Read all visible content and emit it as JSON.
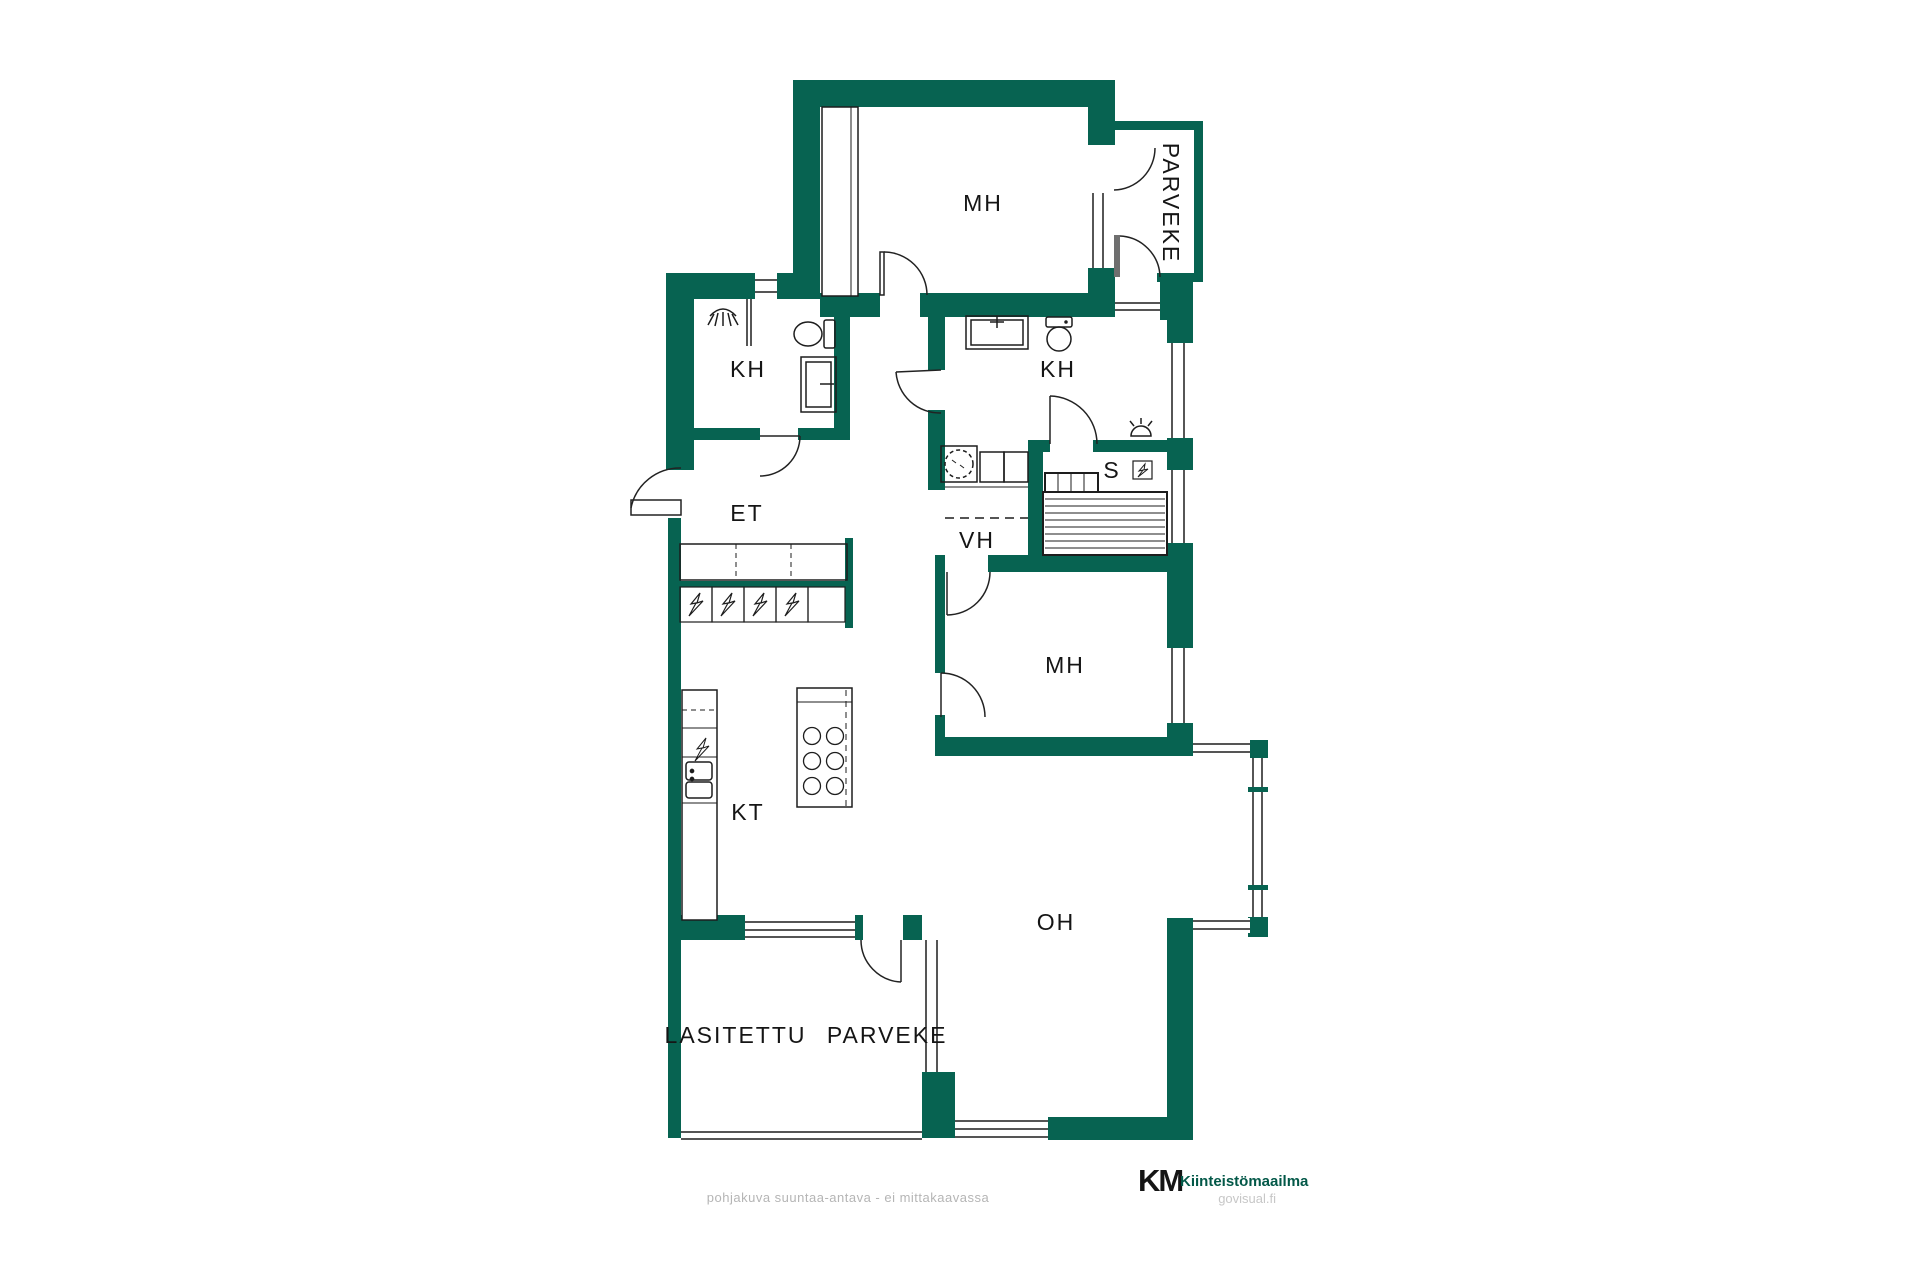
{
  "image": {
    "width": 1920,
    "height": 1280,
    "background": "#ffffff"
  },
  "palette": {
    "wall_green": "#076351",
    "line_black": "#1d1d1d",
    "door_leaf_gray": "#6f6f6f",
    "label_black": "#151515",
    "footer_gray": "#b5b5b5",
    "brand_green_dark": "#035848",
    "brand_green_light": "#3db469"
  },
  "rooms": {
    "mh_top": {
      "label": "MH"
    },
    "parveke_top": {
      "label": "PARVEKE"
    },
    "kh_left": {
      "label": "KH"
    },
    "kh_right": {
      "label": "KH"
    },
    "et": {
      "label": "ET"
    },
    "vh": {
      "label": "VH"
    },
    "sauna": {
      "label": "S"
    },
    "mh_middle": {
      "label": "MH"
    },
    "kt": {
      "label": "KT"
    },
    "oh": {
      "label": "OH"
    },
    "glazed_balcony": {
      "label": "LASITETTU PARVEKE"
    }
  },
  "footer": {
    "disclaimer": "pohjakuva suuntaa-antava - ei mittakaavassa",
    "brand_mark": "KM",
    "brand_name": "Kiinteistömaailma",
    "website": "govisual.fi"
  },
  "icons": [
    "shower-icon",
    "toilet-icon",
    "sink-icon",
    "washing-machine-icon",
    "dryer-cabinet-icon",
    "sauna-stove-icon",
    "sauna-bench-icon",
    "sauna-light-icon",
    "electrical-panel-icon",
    "stove-hob-icon",
    "kitchen-sink-icon",
    "wardrobe-icon",
    "door-arc",
    "window-symbol"
  ]
}
